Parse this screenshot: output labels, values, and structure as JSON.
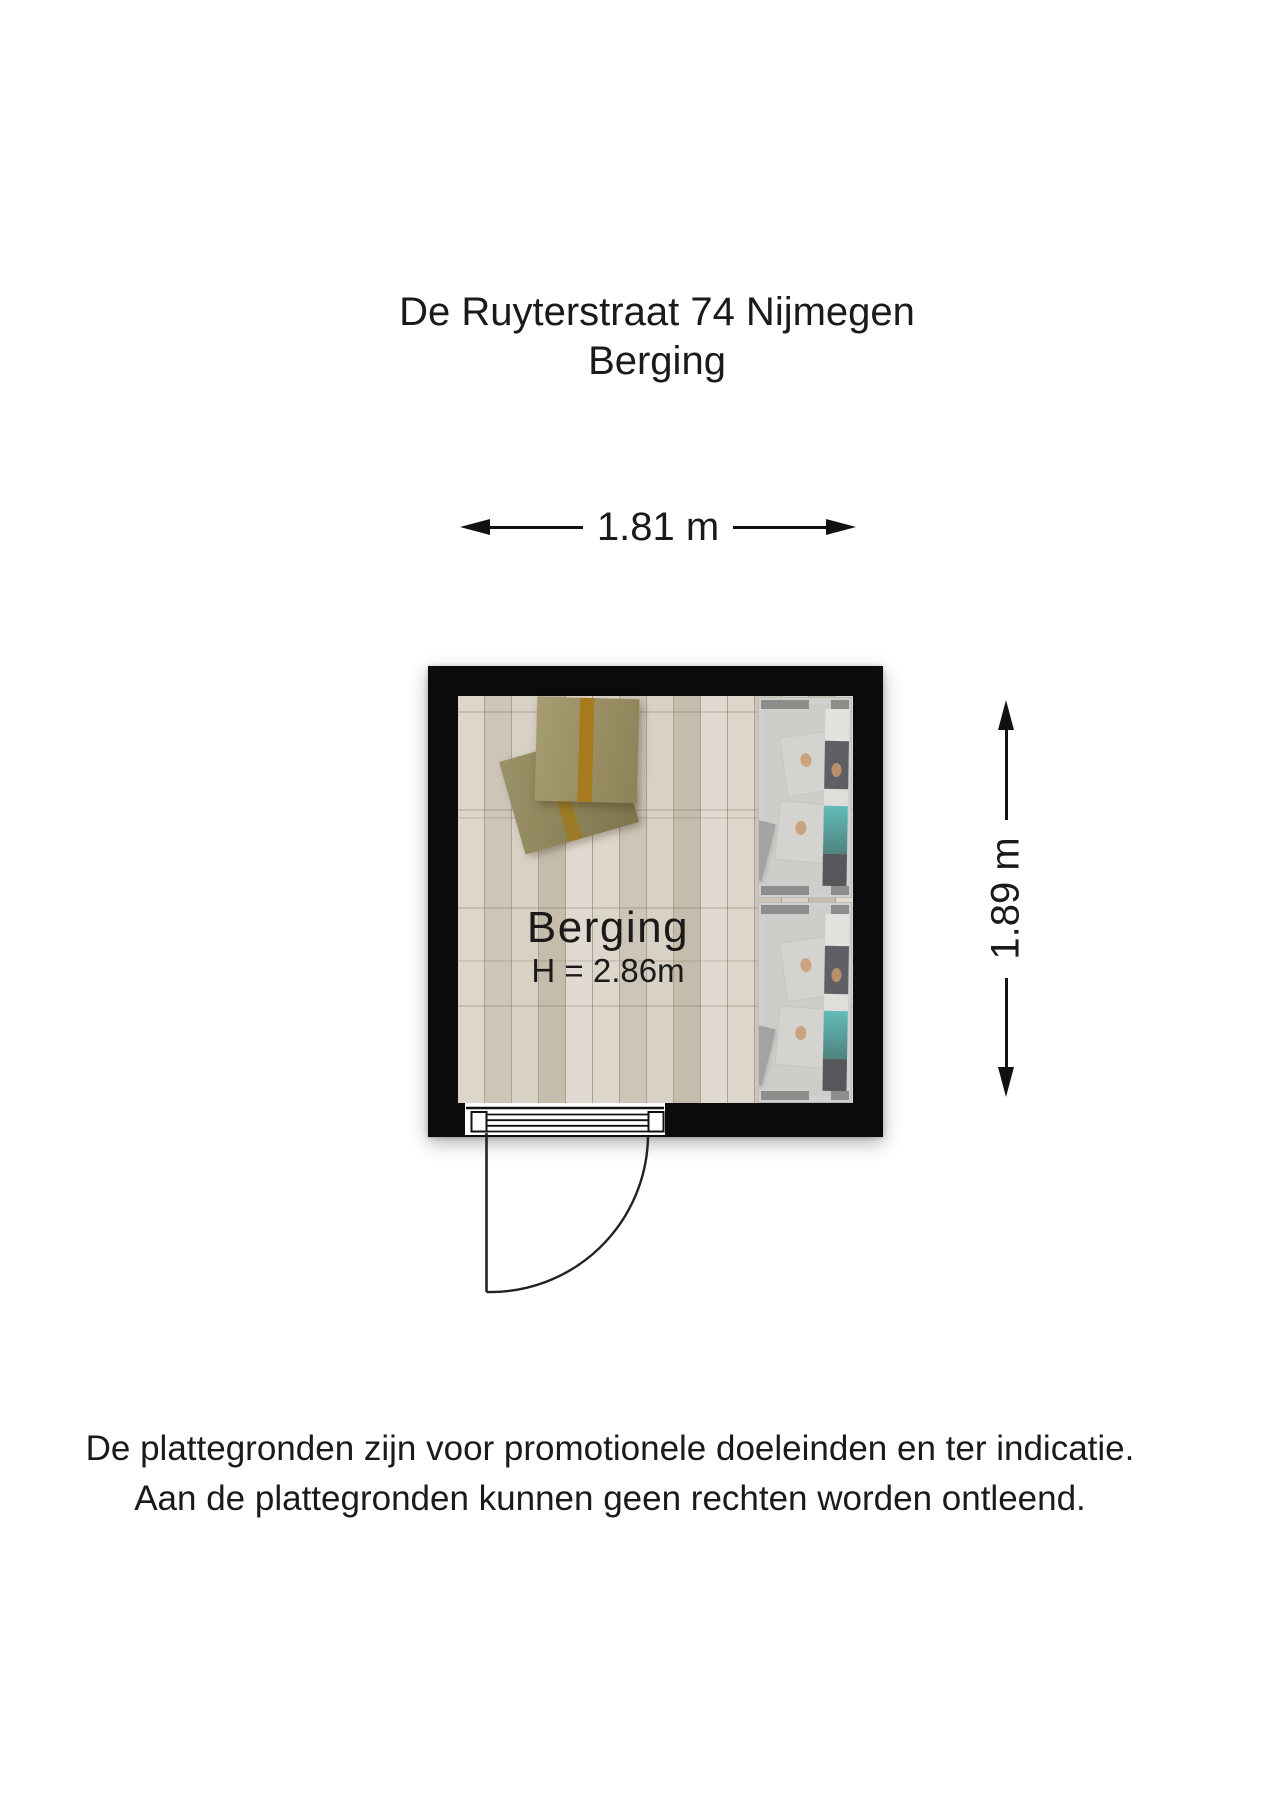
{
  "title": {
    "line1": "De Ruyterstraat 74 Nijmegen",
    "line2": "Berging"
  },
  "dimensions": {
    "width_label": "1.81 m",
    "height_label": "1.89 m"
  },
  "room": {
    "name": "Berging",
    "ceiling_height_label": "H = 2.86m"
  },
  "footer": {
    "line1": "De plattegronden zijn voor promotionele doeleinden en ter indicatie.",
    "line2": "Aan de plattegronden kunnen geen rechten worden ontleend."
  },
  "floorplan": {
    "type": "top-down floor plan",
    "room_count": 1,
    "features": [
      "storage room",
      "bottom door with swing arc",
      "shelving units on right wall",
      "two cardboard boxes on floor"
    ],
    "colors": {
      "wall": "#0b0b0b",
      "floor_light": "#ddd6cb",
      "floor_dark": "#c6bcac",
      "box": "#9d9162",
      "box_under": "#8f8556",
      "tape": "#a87a1e",
      "shelf_body": "#d2d1cf",
      "shelf_tab": "#6b6b6b",
      "book_dark": "#23262e",
      "book_teal": "#1fa7a0",
      "text": "#1a1a1a"
    }
  }
}
